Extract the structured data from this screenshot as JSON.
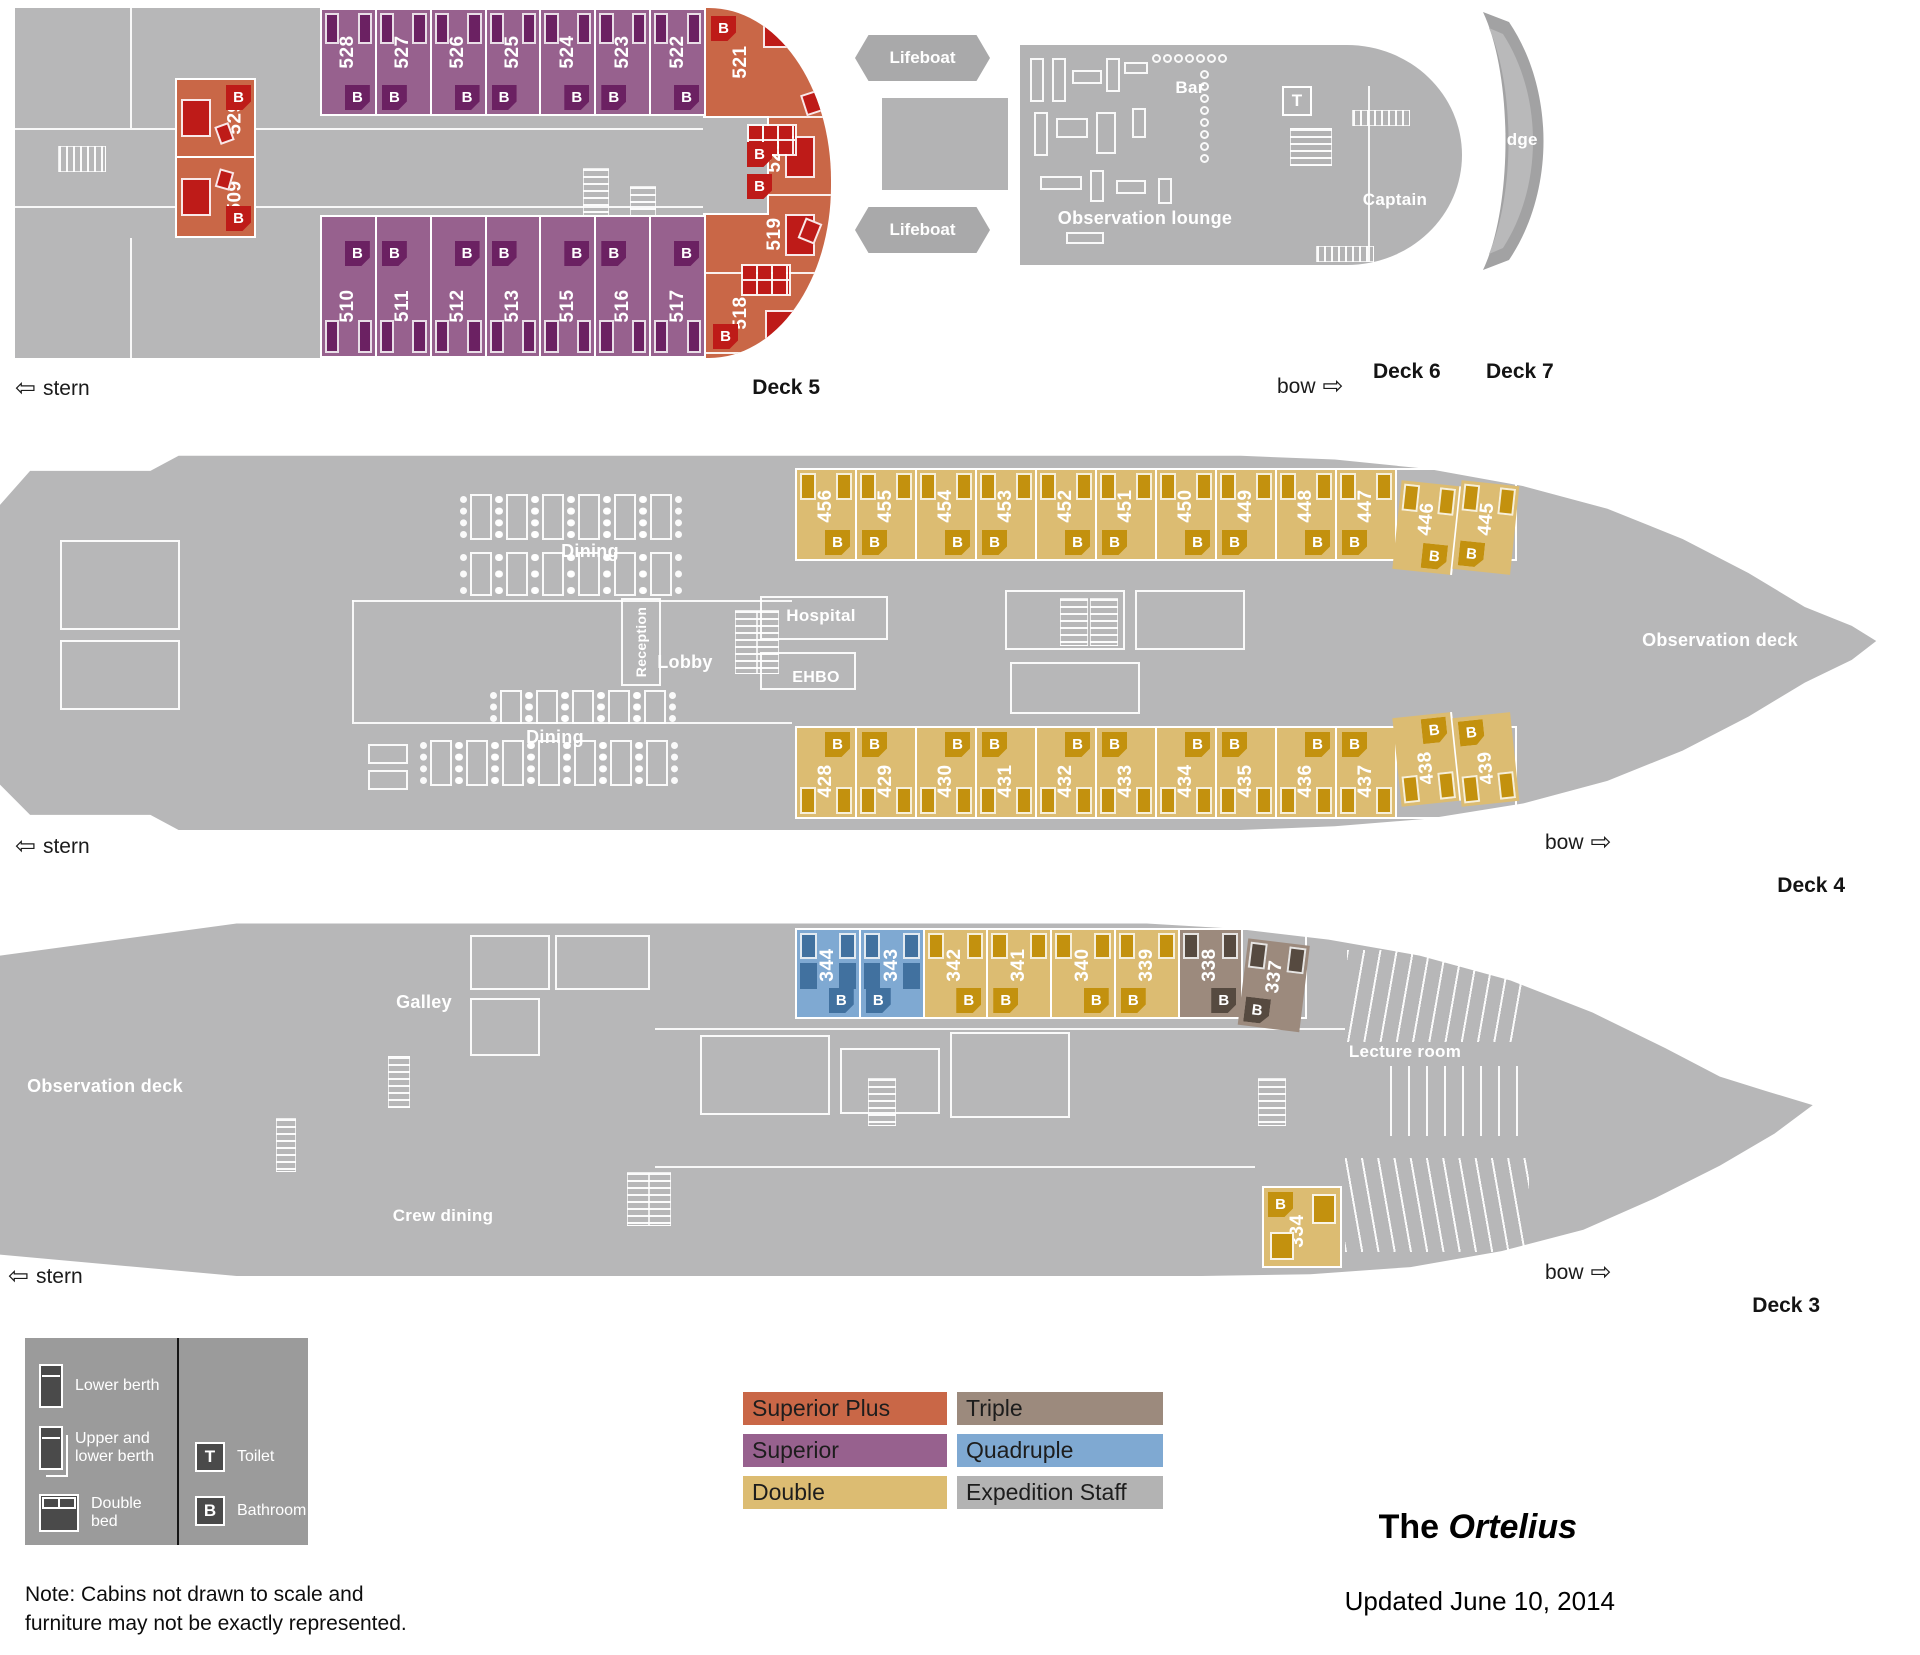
{
  "nav": {
    "stern_arrow": "⇦",
    "stern": "stern",
    "bow": "bow",
    "bow_arrow": "⇨"
  },
  "decks": {
    "d3": "Deck 3",
    "d4": "Deck 4",
    "d5": "Deck 5",
    "d6": "Deck 6",
    "d7": "Deck 7"
  },
  "rooms": {
    "lifeboat": "Lifeboat",
    "observation_lounge": "Observation lounge",
    "bar": "Bar",
    "captain": "Captain",
    "bridge": "Bridge",
    "dining": "Dining",
    "reception": "Reception",
    "lobby": "Lobby",
    "hospital": "Hospital",
    "ehbo": "EHBO",
    "observation_deck": "Observation deck",
    "galley": "Galley",
    "crew_dining": "Crew dining",
    "lecture_room": "Lecture room"
  },
  "badges": {
    "bathroom": "B",
    "toilet": "T"
  },
  "cabins": {
    "deck5_top": [
      {
        "num": "528",
        "type": "superior"
      },
      {
        "num": "527",
        "type": "superior"
      },
      {
        "num": "526",
        "type": "superior"
      },
      {
        "num": "525",
        "type": "superior"
      },
      {
        "num": "524",
        "type": "superior"
      },
      {
        "num": "523",
        "type": "superior"
      },
      {
        "num": "522",
        "type": "superior"
      }
    ],
    "deck5_bottom": [
      {
        "num": "510",
        "type": "superior"
      },
      {
        "num": "511",
        "type": "superior"
      },
      {
        "num": "512",
        "type": "superior"
      },
      {
        "num": "513",
        "type": "superior"
      },
      {
        "num": "515",
        "type": "superior"
      },
      {
        "num": "516",
        "type": "superior"
      },
      {
        "num": "517",
        "type": "superior"
      }
    ],
    "deck5_left": [
      {
        "num": "529",
        "type": "superior_plus"
      },
      {
        "num": "509",
        "type": "superior_plus"
      }
    ],
    "deck5_bow": [
      {
        "num": "521",
        "type": "superior_plus"
      },
      {
        "num": "520",
        "type": "superior_plus"
      },
      {
        "num": "519",
        "type": "superior_plus"
      },
      {
        "num": "518",
        "type": "superior_plus"
      }
    ],
    "deck4_top": [
      {
        "num": "456",
        "type": "double"
      },
      {
        "num": "455",
        "type": "double"
      },
      {
        "num": "454",
        "type": "double"
      },
      {
        "num": "453",
        "type": "double"
      },
      {
        "num": "452",
        "type": "double"
      },
      {
        "num": "451",
        "type": "double"
      },
      {
        "num": "450",
        "type": "double"
      },
      {
        "num": "449",
        "type": "double"
      },
      {
        "num": "448",
        "type": "double"
      },
      {
        "num": "447",
        "type": "double"
      },
      {
        "num": "446",
        "type": "double"
      },
      {
        "num": "445",
        "type": "double"
      }
    ],
    "deck4_bottom": [
      {
        "num": "428",
        "type": "double"
      },
      {
        "num": "429",
        "type": "double"
      },
      {
        "num": "430",
        "type": "double"
      },
      {
        "num": "431",
        "type": "double"
      },
      {
        "num": "432",
        "type": "double"
      },
      {
        "num": "433",
        "type": "double"
      },
      {
        "num": "434",
        "type": "double"
      },
      {
        "num": "435",
        "type": "double"
      },
      {
        "num": "436",
        "type": "double"
      },
      {
        "num": "437",
        "type": "double"
      },
      {
        "num": "438",
        "type": "double"
      },
      {
        "num": "439",
        "type": "double"
      }
    ],
    "deck3_strip": [
      {
        "num": "344",
        "type": "quadruple"
      },
      {
        "num": "343",
        "type": "quadruple"
      },
      {
        "num": "342",
        "type": "double"
      },
      {
        "num": "341",
        "type": "double"
      },
      {
        "num": "340",
        "type": "double"
      },
      {
        "num": "339",
        "type": "double"
      },
      {
        "num": "338",
        "type": "triple"
      },
      {
        "num": "337",
        "type": "triple"
      }
    ],
    "deck3_single": {
      "num": "334",
      "type": "double"
    }
  },
  "legend": {
    "beds": [
      {
        "icon": "single-bed-icon",
        "label": "Lower berth"
      },
      {
        "icon": "bunk-bed-icon",
        "label": "Upper and lower berth"
      },
      {
        "icon": "double-bed-icon",
        "label": "Double bed"
      }
    ],
    "badges": [
      {
        "letter": "T",
        "label": "Toilet"
      },
      {
        "letter": "B",
        "label": "Bathroom"
      }
    ]
  },
  "key": [
    {
      "label": "Superior Plus",
      "color": "#c96747"
    },
    {
      "label": "Triple",
      "color": "#9c8a7d"
    },
    {
      "label": "Superior",
      "color": "#97618e"
    },
    {
      "label": "Quadruple",
      "color": "#7fa9d2"
    },
    {
      "label": "Double",
      "color": "#dcbc72"
    },
    {
      "label": "Expedition Staff",
      "color": "#b3b3b3"
    }
  ],
  "title": {
    "prefix": "The ",
    "ship": "Ortelius"
  },
  "updated": "Updated June 10, 2014",
  "note": "Note: Cabins not drawn to scale and furniture may not be exactly represented."
}
